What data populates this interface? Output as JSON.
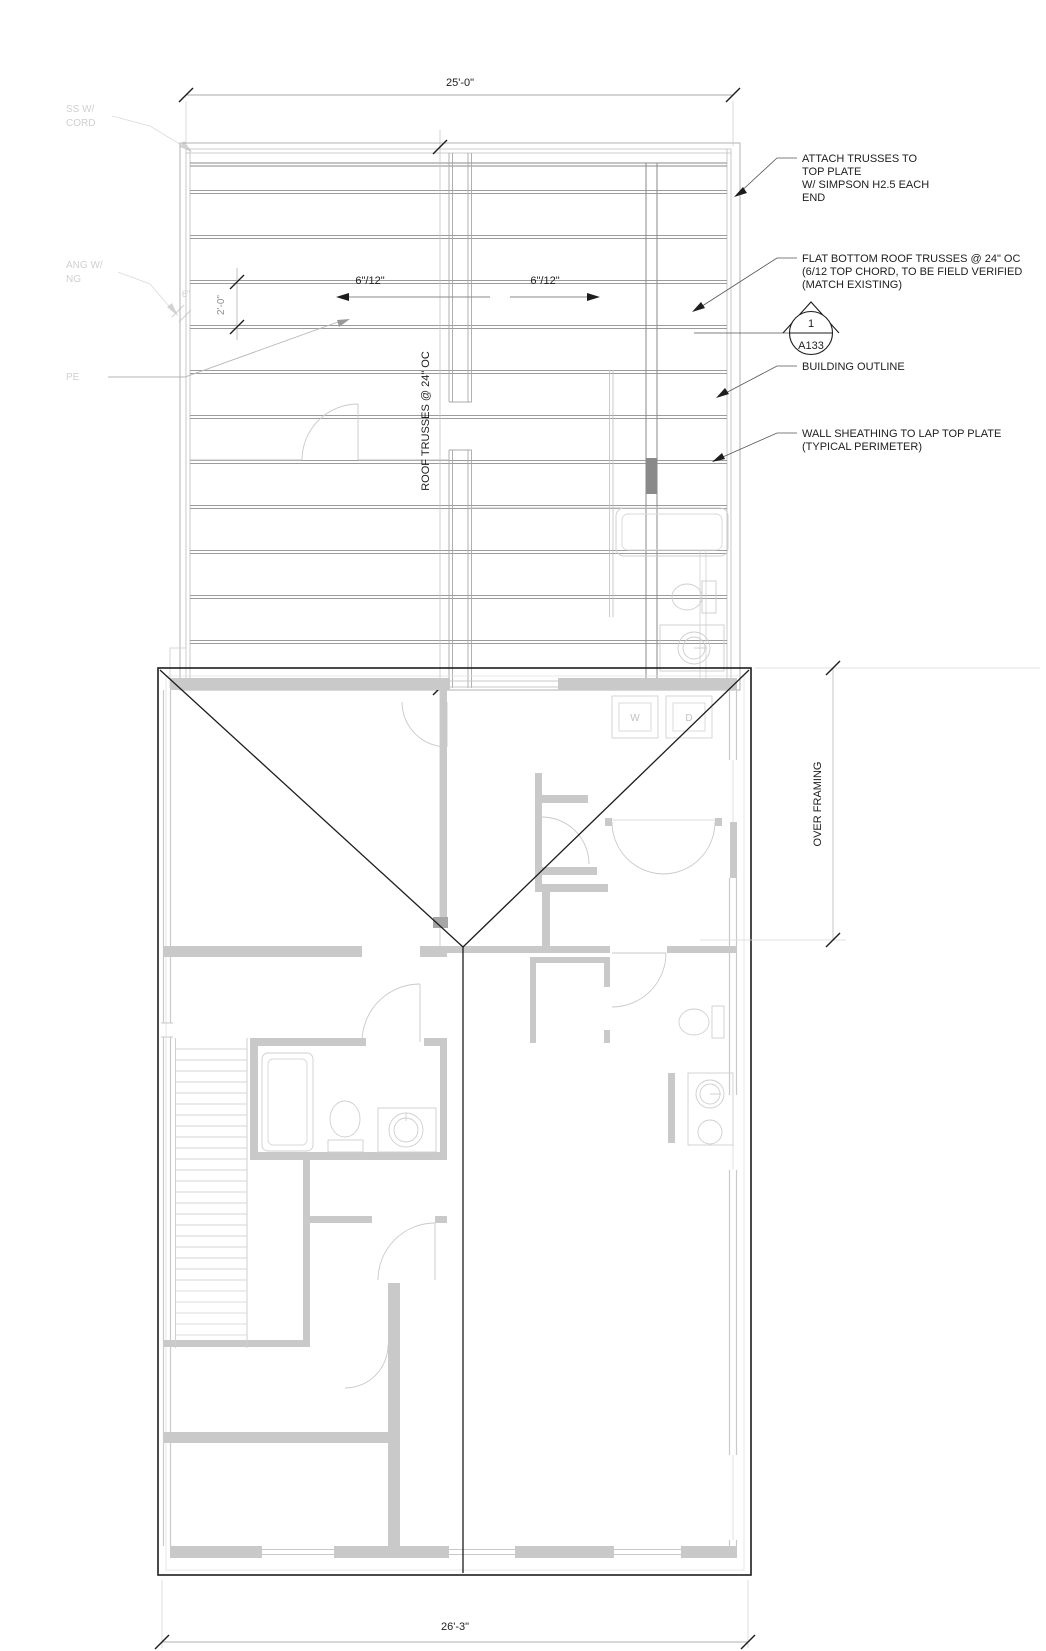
{
  "drawing": {
    "dimensions": {
      "overall_width_top": "25'-0\"",
      "truss_spacing": "2'-0\"",
      "overhang": "6\"",
      "slope_left": "6\"/12\"",
      "slope_right": "6\"/12\"",
      "overall_width_bottom": "26'-3\"",
      "roof_trusses_label": "ROOF TRUSSES @ 24\" OC",
      "over_framing_label": "OVER FRAMING"
    },
    "notes": {
      "attach": {
        "lines": [
          "ATTACH TRUSSES TO",
          "TOP PLATE",
          "W/ SIMPSON H2.5 EACH",
          "END"
        ]
      },
      "flat_bottom": {
        "lines": [
          "FLAT BOTTOM ROOF TRUSSES @ 24\" OC",
          "(6/12 TOP CHORD, TO BE FIELD VERIFIED",
          "(MATCH EXISTING)"
        ]
      },
      "building_outline": {
        "lines": [
          "BUILDING OUTLINE"
        ]
      },
      "wall_sheathing": {
        "lines": [
          "WALL SHEATHING TO LAP TOP PLATE",
          "(TYPICAL PERIMETER)"
        ]
      }
    },
    "callout": {
      "detail_number": "1",
      "sheet_number": "A133"
    },
    "faded_labels": {
      "truss_fragment_1": "SS W/",
      "truss_fragment_2": "CORD",
      "overhang_fragment_1": "ANG W/",
      "overhang_fragment_2": "NG",
      "slope_fragment": "PE"
    },
    "appliances": {
      "washer": "W",
      "dryer": "D"
    },
    "colors": {
      "ink": "#1d1d1d",
      "truss_line": "#9c9c9c",
      "faded_plan": "#c9c9c9",
      "wall_fill": "#c6c6c6"
    }
  }
}
